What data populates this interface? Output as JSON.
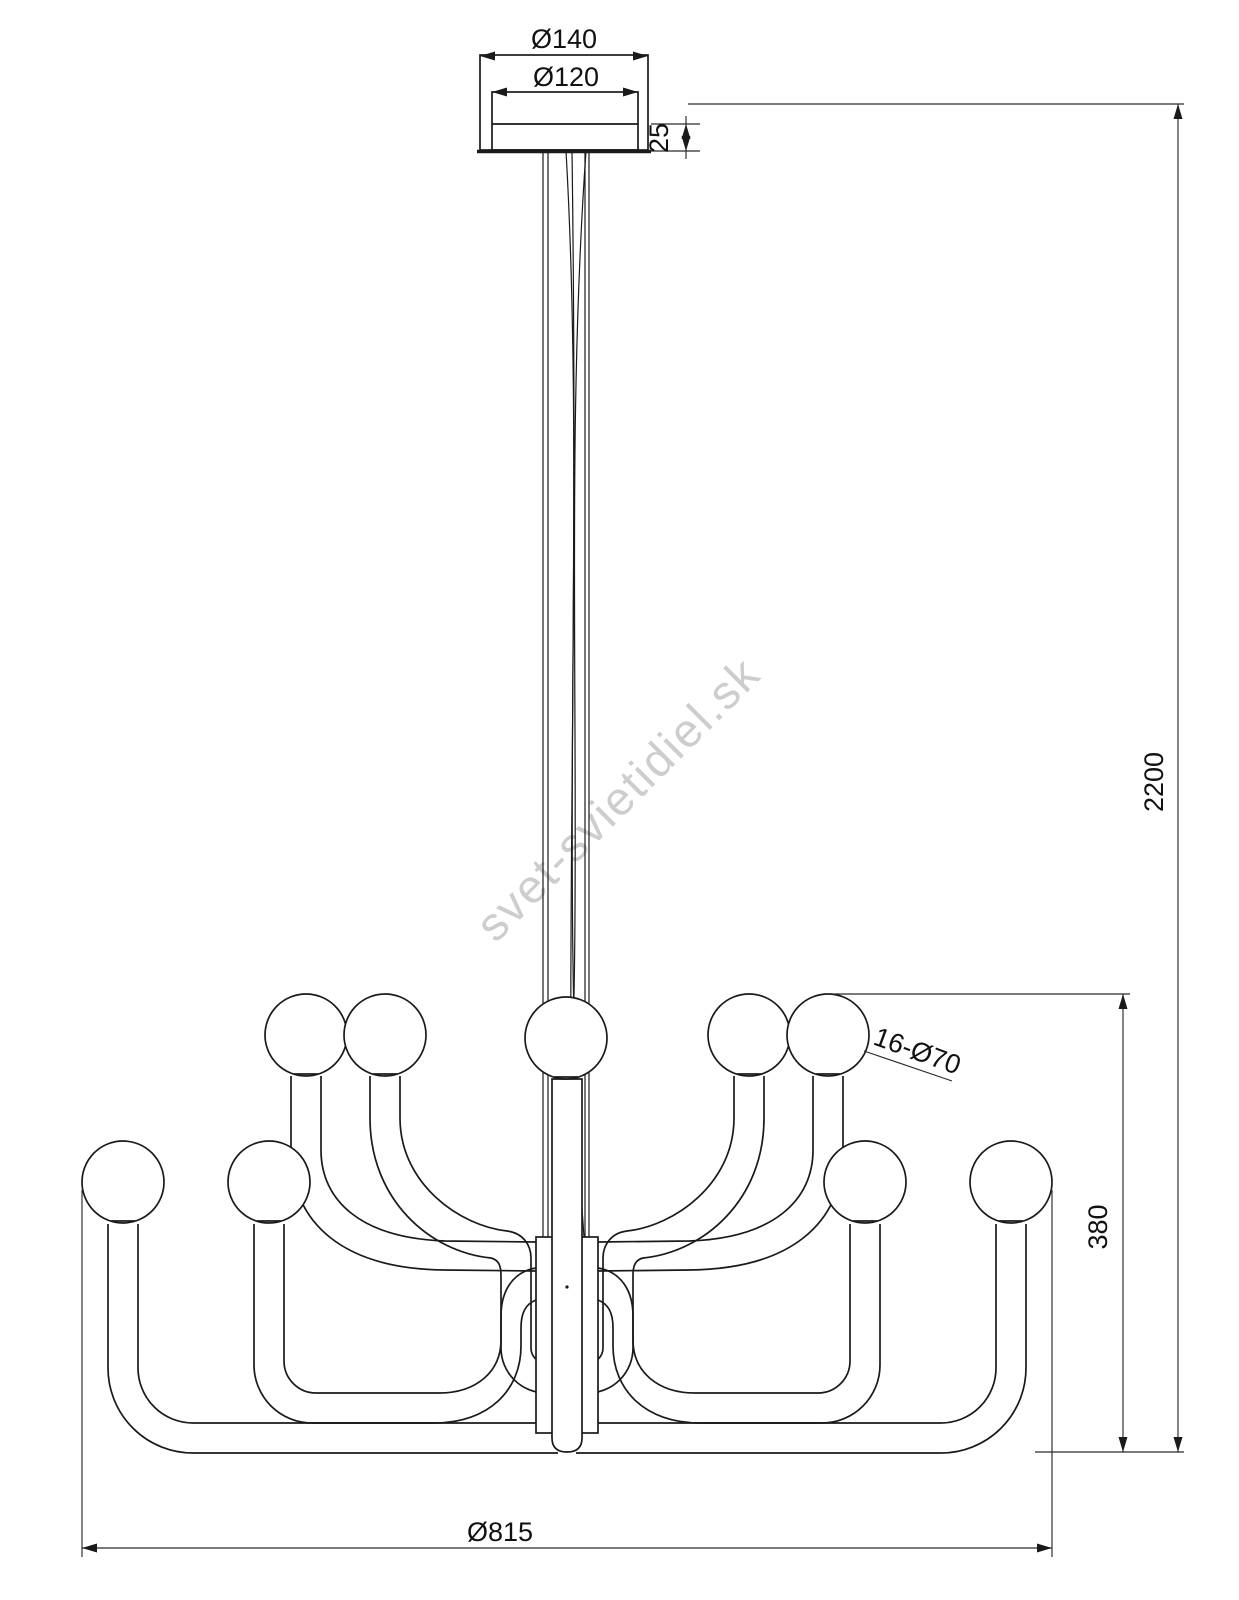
{
  "labels": {
    "canopy_outer_diameter": "Ø140",
    "canopy_inner_diameter": "Ø120",
    "canopy_height": "25",
    "suspension_total_height": "2200",
    "body_height": "380",
    "bulb_count_diameter": "16-Ø70",
    "body_diameter": "Ø815"
  },
  "watermark": {
    "text": "svet-svietidiel.sk",
    "color": "#c8c8c8"
  },
  "colors": {
    "background": "#ffffff",
    "line": "#1a1a1a",
    "dimension_line": "#2b2b2b",
    "text": "#111111"
  }
}
